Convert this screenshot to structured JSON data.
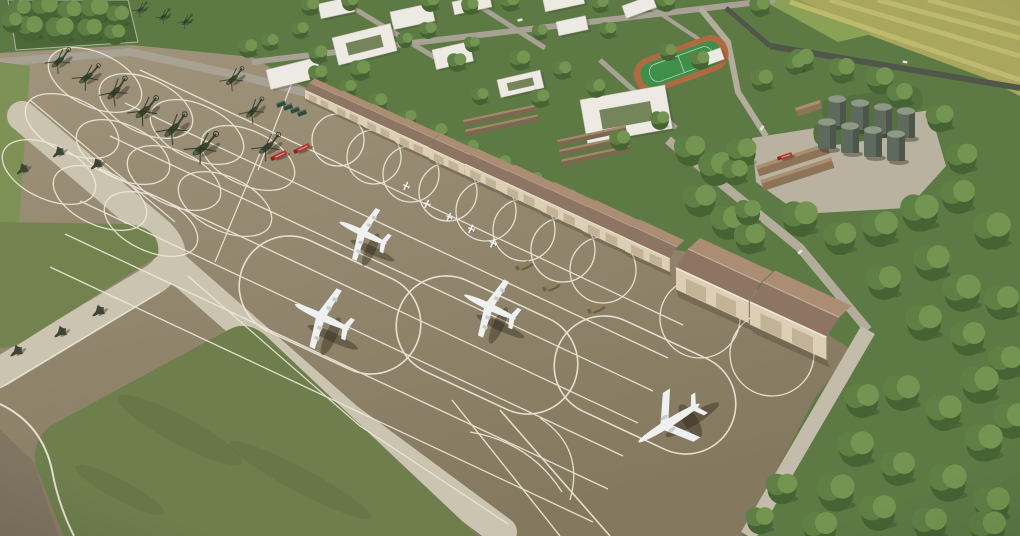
{
  "colors": {
    "apron_top": "#a3967f",
    "apron_bottom": "#84785f",
    "apron_dark": "#7a7060",
    "band": "#cbc4b0",
    "marking": "#ede8d9",
    "grass_left": "#7e9157",
    "grass_island": "#6e7e4d",
    "grass_patch": "#72834f",
    "tree_base": "#5d7a45",
    "grove": "#4c6839",
    "tree_dark": "#466334",
    "tree_mid": "#5f8045",
    "tree_light": "#739551",
    "farm_base": "#a9a75e",
    "farm_stripe": "#bdb96d",
    "farm_green": "#8ba156",
    "track": "#b06a41",
    "field": "#3f8f4a",
    "field_line": "#d9e8d6",
    "building": "#eceae3",
    "building_edge": "#c9c7bd",
    "building_shadow": "rgba(60,60,50,0.25)",
    "court": "#76845b",
    "roof_light": "#ab8d74",
    "roof_dark": "#8e7463",
    "hangar_front": "#dccfb6",
    "hangar_door": "#c2b296",
    "hangar_shadow": "rgba(50,40,25,0.25)",
    "road": "#a8a295",
    "road_light": "#c3bcab",
    "road_mid": "#b3ac9b",
    "road_dark": "#51564b",
    "pad": "#b9b2a0",
    "mound": "#55703e",
    "shed": "#8d7357",
    "shed_light": "#a98f6e",
    "tank_body": "#5f6a5e",
    "tank_top": "#8e9885",
    "tank_shade": "rgba(0,0,0,0.18)",
    "heli_body": "#3a452f",
    "rotor": "#2c3526",
    "plane_white": "#eff1f0",
    "plane_gray": "#c7cbca",
    "fighter": "#3f4536",
    "shadow": "rgba(40,34,22,0.38)",
    "fire_red": "#b23226",
    "fire_dark": "#8d2018",
    "army_tan": "#8f7f5c",
    "army_dark": "#6f6247",
    "container": "#2f4a38",
    "barrack": "#7b6851",
    "barrack_light": "#a28a68",
    "fence": "#d8d4c6",
    "grass_streak": "rgba(30,40,15,0.08)"
  },
  "objects": {
    "hangars": [
      [
        305,
        90,
        0,
        0.78
      ],
      [
        333,
        103,
        0,
        0.83
      ],
      [
        363,
        117,
        0,
        0.88
      ],
      [
        395,
        132,
        0,
        0.93
      ],
      [
        429,
        148,
        0,
        0.98
      ],
      [
        465,
        164,
        0,
        1.03
      ],
      [
        502,
        181,
        0,
        1.08
      ],
      [
        541,
        199,
        0,
        1.13
      ],
      [
        582,
        218,
        0,
        1.18
      ],
      [
        625,
        238,
        0,
        1.23
      ]
    ],
    "hangars_detached": [
      [
        676,
        268,
        0,
        2.0
      ],
      [
        750,
        302,
        0,
        2.1
      ]
    ],
    "helicopters": [
      [
        58,
        62,
        -40,
        0.85
      ],
      [
        86,
        78,
        -36,
        0.9
      ],
      [
        114,
        93,
        -44,
        0.95
      ],
      [
        143,
        112,
        -38,
        1.0
      ],
      [
        172,
        130,
        -42,
        1.05
      ],
      [
        201,
        149,
        -36,
        1.1
      ],
      [
        232,
        80,
        -40,
        0.8
      ],
      [
        252,
        112,
        -44,
        0.85
      ],
      [
        266,
        148,
        -38,
        0.95
      ],
      [
        140,
        10,
        -40,
        0.5
      ],
      [
        163,
        17,
        -42,
        0.5
      ],
      [
        185,
        22,
        -38,
        0.5
      ]
    ],
    "turboprops": [
      [
        363,
        233,
        25,
        1.0
      ],
      [
        322,
        317,
        25,
        1.15
      ],
      [
        490,
        307,
        25,
        1.1
      ]
    ],
    "jets": [
      [
        669,
        423,
        -32,
        1.2
      ]
    ],
    "small_planes": [
      [
        406,
        186,
        25,
        0.5
      ],
      [
        427,
        204,
        25,
        0.5
      ],
      [
        449,
        217,
        25,
        0.5
      ],
      [
        471,
        229,
        25,
        0.52
      ],
      [
        493,
        243,
        25,
        0.55
      ]
    ],
    "dark_aircraft": [
      [
        22,
        170,
        -40,
        0.8
      ],
      [
        58,
        153,
        -40,
        0.8
      ],
      [
        96,
        165,
        -40,
        0.8
      ],
      [
        16,
        352,
        -38,
        0.85
      ],
      [
        60,
        333,
        -38,
        0.85
      ],
      [
        98,
        312,
        -38,
        0.85
      ]
    ],
    "fire_trucks": [
      [
        280,
        155,
        -25,
        1
      ],
      [
        303,
        148,
        -25,
        1
      ],
      [
        786,
        156,
        -18,
        0.9
      ]
    ],
    "army_trucks": [
      [
        524,
        265,
        -25,
        1
      ],
      [
        551,
        286,
        -25,
        1
      ],
      [
        596,
        308,
        -25,
        1
      ]
    ],
    "containers": [
      [
        281,
        104,
        -20,
        1
      ],
      [
        288,
        107,
        -20,
        1
      ],
      [
        295,
        110,
        -20,
        1
      ],
      [
        302,
        113,
        -20,
        1
      ]
    ],
    "cars": [
      [
        800,
        252,
        -42,
        1
      ],
      [
        762,
        128,
        -55,
        1
      ],
      [
        520,
        20,
        -12,
        1
      ],
      [
        905,
        62,
        10,
        0.9
      ]
    ],
    "fuel_tanks": [
      [
        837,
        112
      ],
      [
        860,
        116
      ],
      [
        883,
        120
      ],
      [
        906,
        124
      ],
      [
        827,
        135
      ],
      [
        850,
        139
      ],
      [
        873,
        143
      ],
      [
        896,
        147
      ]
    ],
    "buildings": [
      [
        318,
        4,
        -12,
        34,
        15,
        "b"
      ],
      [
        390,
        12,
        -12,
        42,
        18,
        "b"
      ],
      [
        452,
        2,
        -12,
        38,
        13,
        "b"
      ],
      [
        543,
        0,
        -12,
        40,
        12,
        "b"
      ],
      [
        622,
        6,
        -20,
        32,
        13,
        "b"
      ],
      [
        332,
        38,
        -14,
        60,
        28,
        "c"
      ],
      [
        432,
        50,
        -13,
        38,
        20,
        "b"
      ],
      [
        497,
        80,
        -13,
        44,
        18,
        "c"
      ],
      [
        556,
        22,
        -12,
        30,
        14,
        "b"
      ],
      [
        266,
        70,
        -14,
        52,
        20,
        "b"
      ],
      [
        580,
        100,
        -10,
        86,
        44,
        "c"
      ],
      [
        692,
        58,
        -20,
        30,
        12,
        "b"
      ]
    ],
    "barracks": [
      [
        463,
        120,
        -12,
        74,
        2
      ],
      [
        557,
        140,
        -12,
        70,
        3
      ]
    ],
    "heli_ovals": [
      [
        95,
        80
      ],
      [
        146,
        106
      ],
      [
        197,
        132
      ],
      [
        248,
        158
      ],
      [
        72,
        126
      ],
      [
        123,
        152
      ],
      [
        174,
        178
      ],
      [
        225,
        204
      ],
      [
        49,
        172
      ],
      [
        100,
        198
      ],
      [
        151,
        224
      ]
    ],
    "stands": [
      [
        330,
        305
      ],
      [
        487,
        345
      ],
      [
        645,
        385
      ]
    ],
    "hangar_circles": [
      [
        338,
        140,
        26
      ],
      [
        374,
        157,
        27
      ],
      [
        411,
        174,
        28
      ],
      [
        448,
        192,
        29
      ],
      [
        486,
        211,
        30
      ],
      [
        524,
        230,
        31
      ],
      [
        563,
        250,
        32
      ],
      [
        603,
        270,
        33
      ],
      [
        700,
        318,
        40
      ],
      [
        772,
        354,
        42
      ]
    ],
    "tree_blobs": [
      [
        20,
        10,
        0,
        1.3
      ],
      [
        45,
        8,
        0,
        1.5
      ],
      [
        70,
        12,
        0,
        1.4
      ],
      [
        95,
        10,
        0,
        1.6
      ],
      [
        118,
        16,
        0,
        1.3
      ],
      [
        30,
        28,
        0,
        1.5
      ],
      [
        60,
        30,
        0,
        1.6
      ],
      [
        90,
        30,
        0,
        1.4
      ],
      [
        115,
        34,
        0,
        1.2
      ],
      [
        12,
        22,
        0,
        1.2
      ],
      [
        310,
        6,
        0,
        1.1
      ],
      [
        350,
        2,
        0,
        1.0
      ],
      [
        430,
        2,
        0,
        1.1
      ],
      [
        470,
        6,
        0,
        1.0
      ],
      [
        510,
        2,
        0,
        1.1
      ],
      [
        600,
        4,
        0,
        1.0
      ],
      [
        666,
        2,
        0,
        1.1
      ],
      [
        760,
        6,
        0,
        1.2
      ],
      [
        300,
        30,
        0,
        1.0
      ],
      [
        318,
        54,
        0,
        1.1
      ],
      [
        360,
        70,
        0,
        1.2
      ],
      [
        405,
        40,
        0,
        0.9
      ],
      [
        428,
        30,
        0,
        1.0
      ],
      [
        457,
        62,
        0,
        1.1
      ],
      [
        472,
        44,
        0,
        0.9
      ],
      [
        520,
        60,
        0,
        1.2
      ],
      [
        540,
        32,
        0,
        0.9
      ],
      [
        562,
        70,
        0,
        1.1
      ],
      [
        608,
        30,
        0,
        1.0
      ],
      [
        596,
        88,
        0,
        1.1
      ],
      [
        668,
        52,
        0,
        1.0
      ],
      [
        700,
        60,
        0,
        1.1
      ],
      [
        480,
        96,
        0,
        1.0
      ],
      [
        540,
        98,
        0,
        1.1
      ],
      [
        620,
        140,
        0,
        1.2
      ],
      [
        660,
        120,
        0,
        1.1
      ],
      [
        318,
        74,
        0,
        1.1
      ],
      [
        348,
        88,
        0,
        1.0
      ],
      [
        378,
        102,
        0,
        1.1
      ],
      [
        408,
        118,
        0,
        1.0
      ],
      [
        438,
        132,
        0,
        1.1
      ],
      [
        470,
        148,
        0,
        1.0
      ],
      [
        502,
        164,
        0,
        1.1
      ],
      [
        534,
        180,
        0,
        1.0
      ],
      [
        568,
        198,
        0,
        1.1
      ],
      [
        602,
        216,
        0,
        1.0
      ],
      [
        636,
        234,
        0,
        1.1
      ],
      [
        690,
        150,
        0,
        1.8
      ],
      [
        716,
        168,
        0,
        2.0
      ],
      [
        742,
        152,
        0,
        1.7
      ],
      [
        700,
        200,
        0,
        1.9
      ],
      [
        728,
        222,
        0,
        2.0
      ],
      [
        750,
        238,
        0,
        1.8
      ],
      [
        800,
        218,
        0,
        2.1
      ],
      [
        840,
        238,
        0,
        1.9
      ],
      [
        880,
        228,
        0,
        2.1
      ],
      [
        920,
        212,
        0,
        2.2
      ],
      [
        958,
        196,
        0,
        2.0
      ],
      [
        992,
        230,
        0,
        2.2
      ],
      [
        932,
        262,
        0,
        2.1
      ],
      [
        884,
        282,
        0,
        2.0
      ],
      [
        962,
        292,
        0,
        2.2
      ],
      [
        1002,
        302,
        0,
        2.0
      ],
      [
        924,
        322,
        0,
        2.1
      ],
      [
        968,
        338,
        0,
        2.0
      ],
      [
        1006,
        362,
        0,
        2.0
      ],
      [
        980,
        384,
        0,
        2.2
      ],
      [
        1012,
        420,
        0,
        2.1
      ],
      [
        880,
        80,
        0,
        1.6
      ],
      [
        842,
        70,
        0,
        1.5
      ],
      [
        802,
        60,
        0,
        1.4
      ],
      [
        762,
        80,
        0,
        1.3
      ],
      [
        900,
        95,
        0,
        1.5
      ],
      [
        940,
        118,
        0,
        1.6
      ],
      [
        962,
        158,
        0,
        1.8
      ],
      [
        735,
        172,
        0,
        1.5
      ],
      [
        748,
        212,
        0,
        1.5
      ],
      [
        795,
        64,
        0,
        1.2
      ],
      [
        862,
        400,
        0,
        2.0
      ],
      [
        902,
        392,
        0,
        2.1
      ],
      [
        944,
        412,
        0,
        2.1
      ],
      [
        984,
        442,
        0,
        2.2
      ],
      [
        856,
        448,
        0,
        2.1
      ],
      [
        898,
        468,
        0,
        2.0
      ],
      [
        948,
        482,
        0,
        2.2
      ],
      [
        992,
        504,
        0,
        2.1
      ],
      [
        836,
        492,
        0,
        2.2
      ],
      [
        878,
        512,
        0,
        2.1
      ],
      [
        930,
        524,
        0,
        2.0
      ],
      [
        988,
        528,
        0,
        2.1
      ],
      [
        820,
        528,
        0,
        2.0
      ],
      [
        760,
        520,
        0,
        1.6
      ],
      [
        782,
        488,
        0,
        1.8
      ],
      [
        248,
        48,
        0,
        1.1
      ],
      [
        270,
        42,
        0,
        1.0
      ]
    ]
  },
  "stamps": [
    {
      "list": "objects.tree_blobs",
      "symbol": "sym-tree",
      "layer": "layer-trees",
      "name": "tree-icon"
    },
    {
      "list": "objects.fuel_tanks",
      "symbol": "sym-tank",
      "layer": "layer-fuel",
      "name": "fuel-tank"
    },
    {
      "list": "objects.hangars",
      "symbol": "sym-hangar",
      "layer": "layer-hangars",
      "name": "hangar"
    },
    {
      "list": "objects.hangars_detached",
      "symbol": "sym-hangar",
      "layer": "layer-hangars",
      "name": "hangar-detached"
    },
    {
      "list": "objects.containers",
      "symbol": "sym-container",
      "layer": "layer-vehicles",
      "name": "container"
    },
    {
      "list": "objects.fire_trucks",
      "symbol": "sym-firetruck",
      "layer": "layer-vehicles",
      "name": "fire-truck"
    },
    {
      "list": "objects.army_trucks",
      "symbol": "sym-armytruck",
      "layer": "layer-vehicles",
      "name": "army-truck"
    },
    {
      "list": "objects.cars",
      "symbol": "sym-car",
      "layer": "layer-vehicles",
      "name": "car"
    },
    {
      "list": "objects.helicopters",
      "symbol": "sym-heli",
      "layer": "layer-aircraft",
      "name": "helicopter"
    },
    {
      "list": "objects.turboprops",
      "symbol": "sym-turboprop",
      "layer": "layer-aircraft",
      "name": "turboprop-airplane"
    },
    {
      "list": "objects.jets",
      "symbol": "sym-jet",
      "layer": "layer-aircraft",
      "name": "jet-airplane"
    },
    {
      "list": "objects.small_planes",
      "symbol": "sym-smallplane",
      "layer": "layer-aircraft",
      "name": "small-airplane"
    },
    {
      "list": "objects.dark_aircraft",
      "symbol": "sym-fighter",
      "layer": "layer-aircraft",
      "name": "dark-aircraft"
    }
  ]
}
